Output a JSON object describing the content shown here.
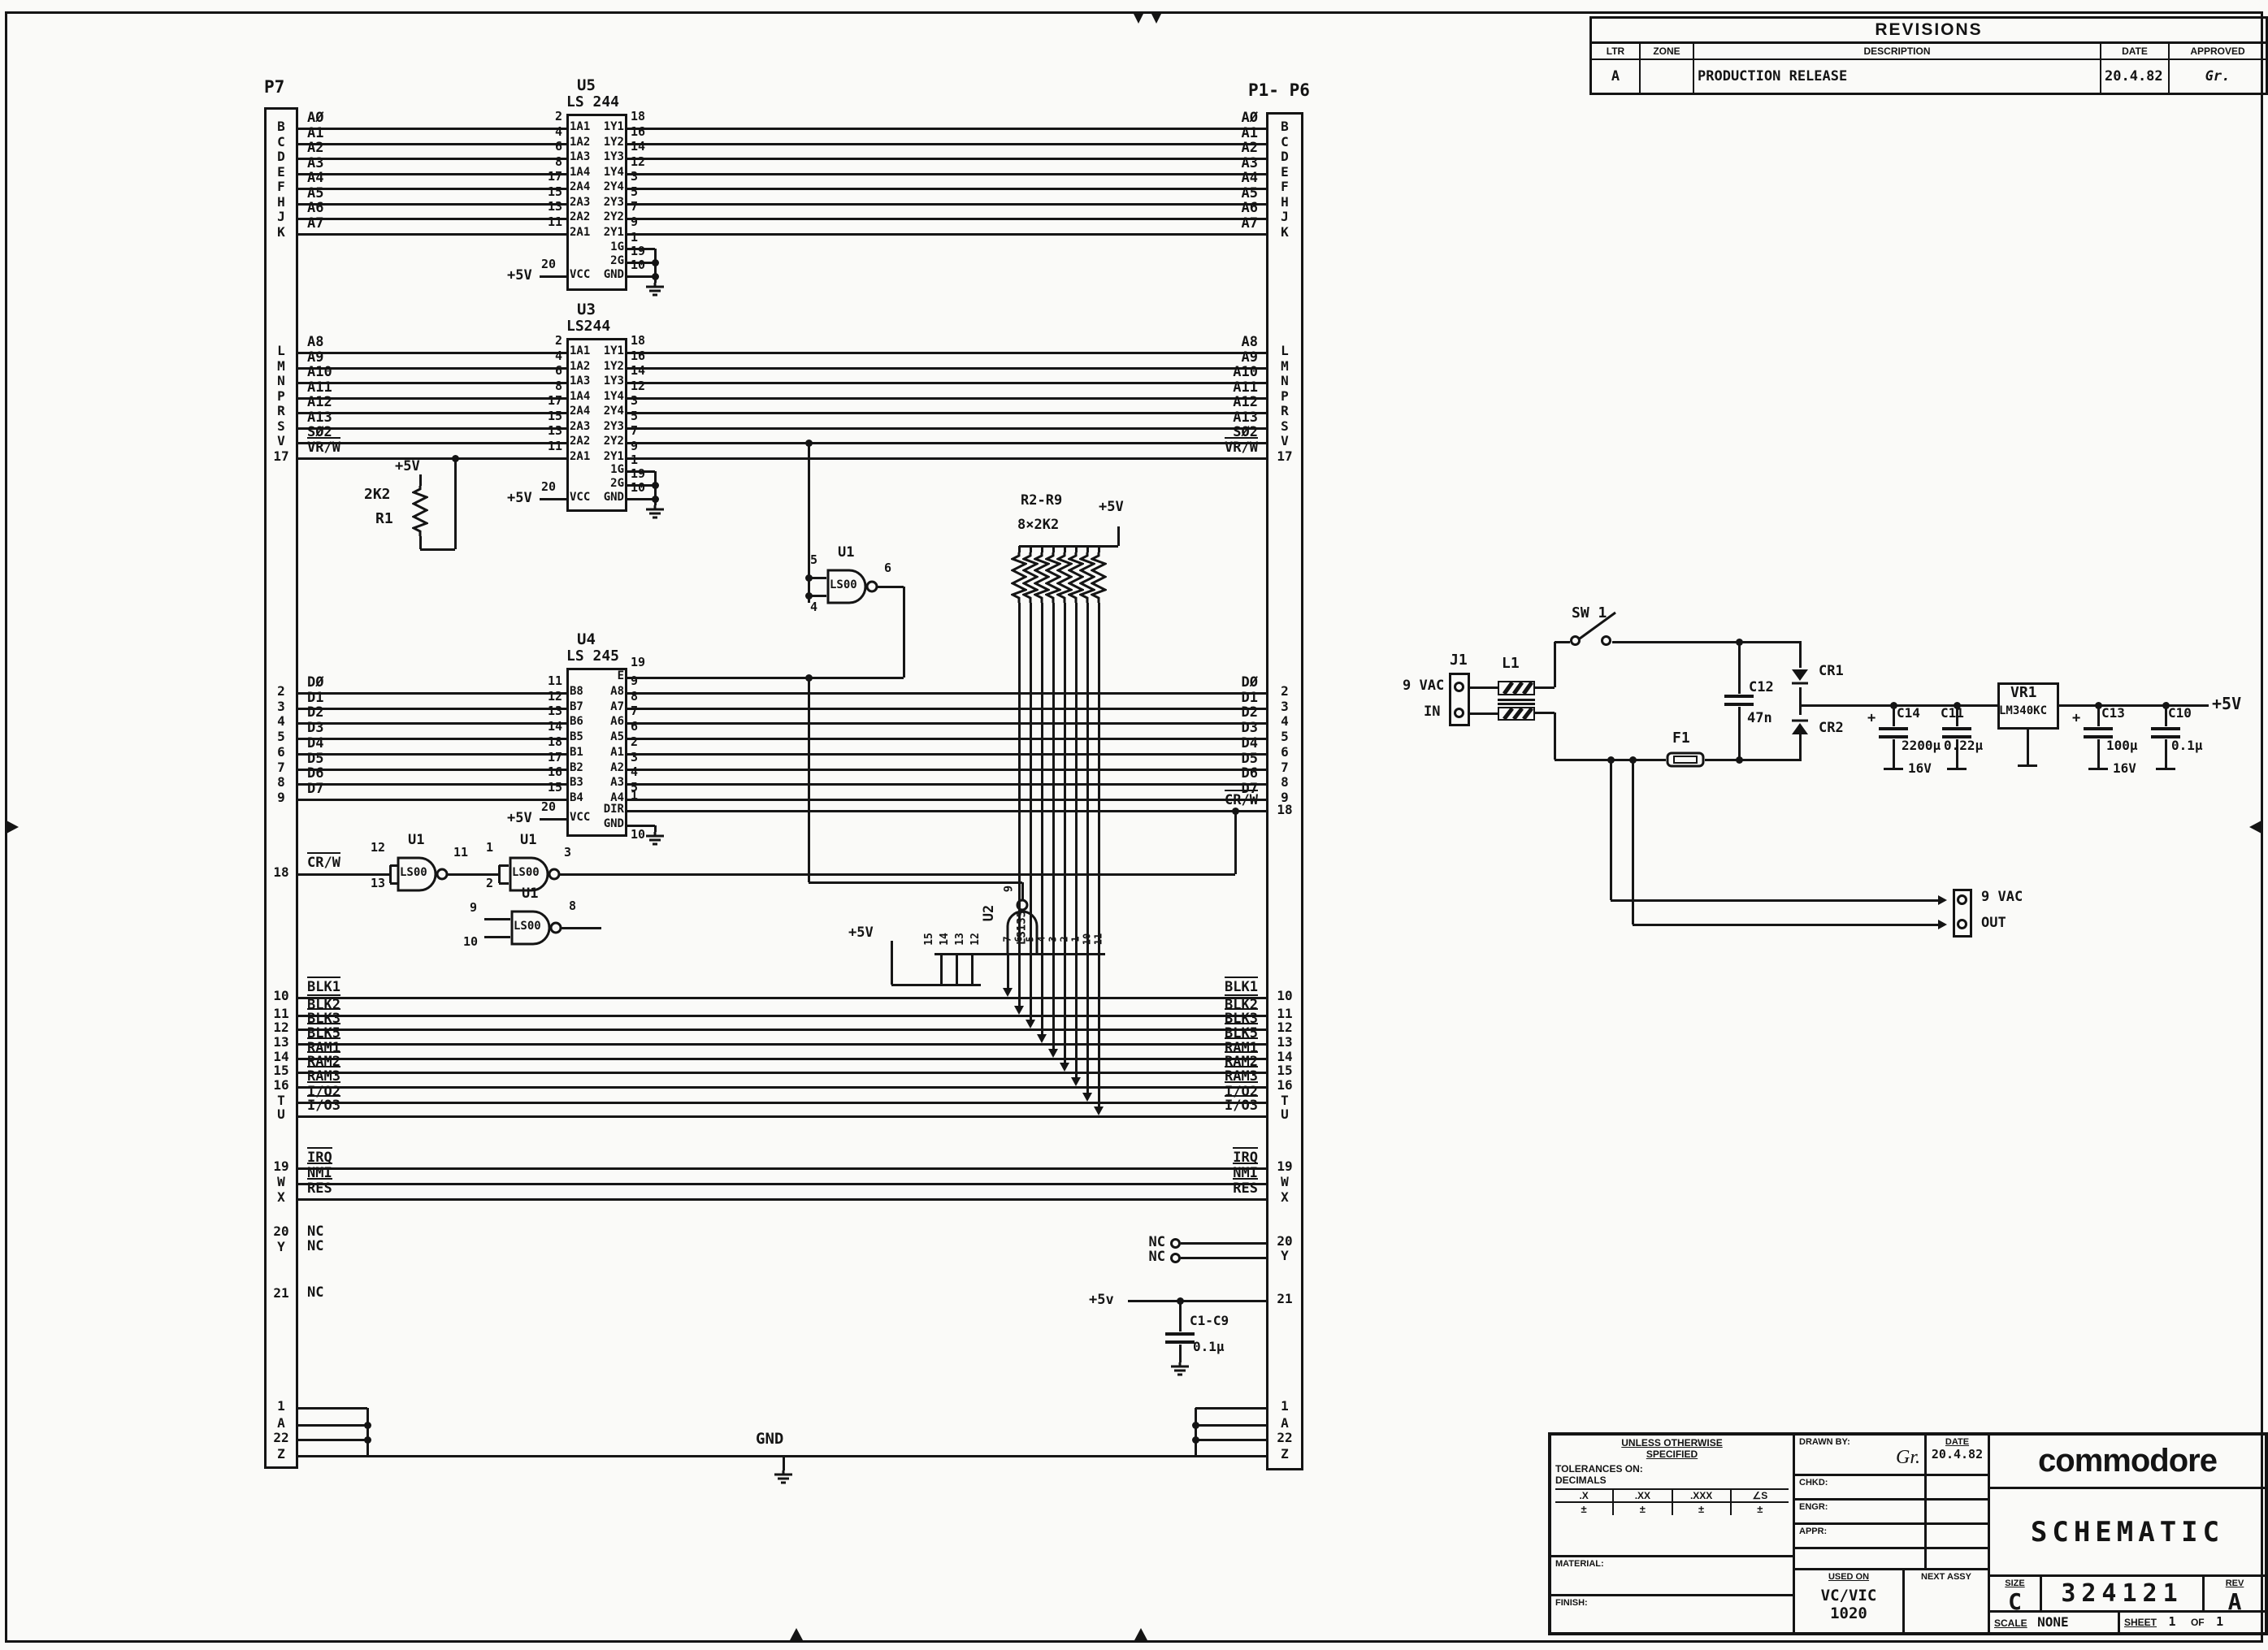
{
  "revisions": {
    "title": "REVISIONS",
    "col_ltr": "LTR",
    "col_zone": "ZONE",
    "col_desc": "DESCRIPTION",
    "col_date": "DATE",
    "col_appr": "APPROVED",
    "row_ltr": "A",
    "row_zone": "",
    "row_desc": "PRODUCTION RELEASE",
    "row_date": "20.4.82",
    "row_appr": "Gr."
  },
  "title_block": {
    "spec_note_1": "UNLESS OTHERWISE",
    "spec_note_2": "SPECIFIED",
    "tolerances": "TOLERANCES ON:",
    "decimals": "DECIMALS",
    "tol_x": ".X",
    "tol_xx": ".XX",
    "tol_xxx": ".XXX",
    "tol_ang": "∠S",
    "pm": "±",
    "material": "MATERIAL:",
    "finish": "FINISH:",
    "drawn_by": "DRAWN BY:",
    "drawn_sig": "Gr.",
    "date_label": "DATE",
    "date": "20.4.82",
    "chkd": "CHKD:",
    "engr": "ENGR:",
    "appr": "APPR:",
    "used_on": "USED ON",
    "used_on_value_1": "VC/VIC",
    "used_on_value_2": "1020",
    "next_assy": "NEXT ASSY",
    "brand": "commodore",
    "title": "SCHEMATIC",
    "size_label": "SIZE",
    "size": "C",
    "number": "324121",
    "rev_label": "REV",
    "rev": "A",
    "scale_label": "SCALE",
    "scale": "NONE",
    "sheet_label": "SHEET",
    "sheet_no": "1",
    "of_label": "OF",
    "of_no": "1"
  },
  "schematic": {
    "connector_left": "P7",
    "connector_right": "P1- P6",
    "plus5v": "+5V",
    "plus5v_low": "+5v",
    "gnd": "GND",
    "nc": "NC",
    "u5": {
      "ref": "U5",
      "part": "LS 244",
      "rows": [
        {
          "signal": "AØ",
          "conn": "B",
          "pin_in": "2",
          "label_in": "1A1",
          "label_out": "1Y1",
          "pin_out": "18"
        },
        {
          "signal": "A1",
          "conn": "C",
          "pin_in": "4",
          "label_in": "1A2",
          "label_out": "1Y2",
          "pin_out": "16"
        },
        {
          "signal": "A2",
          "conn": "D",
          "pin_in": "6",
          "label_in": "1A3",
          "label_out": "1Y3",
          "pin_out": "14"
        },
        {
          "signal": "A3",
          "conn": "E",
          "pin_in": "8",
          "label_in": "1A4",
          "label_out": "1Y4",
          "pin_out": "12"
        },
        {
          "signal": "A4",
          "conn": "F",
          "pin_in": "17",
          "label_in": "2A4",
          "label_out": "2Y4",
          "pin_out": "3"
        },
        {
          "signal": "A5",
          "conn": "H",
          "pin_in": "15",
          "label_in": "2A3",
          "label_out": "2Y3",
          "pin_out": "5"
        },
        {
          "signal": "A6",
          "conn": "J",
          "pin_in": "13",
          "label_in": "2A2",
          "label_out": "2Y2",
          "pin_out": "7"
        },
        {
          "signal": "A7",
          "conn": "K",
          "pin_in": "11",
          "label_in": "2A1",
          "label_out": "2Y1",
          "pin_out": "9"
        }
      ],
      "enables": [
        {
          "label": "1G",
          "pin": "1"
        },
        {
          "label": "2G",
          "pin": "19"
        }
      ],
      "gnd": {
        "label": "GND",
        "pin": "10"
      },
      "vcc": {
        "label": "VCC",
        "pin": "20"
      }
    },
    "u3": {
      "ref": "U3",
      "part": "LS244",
      "rows": [
        {
          "signal": "A8",
          "conn": "L",
          "pin_in": "2",
          "label_in": "1A1",
          "label_out": "1Y1",
          "pin_out": "18"
        },
        {
          "signal": "A9",
          "conn": "M",
          "pin_in": "4",
          "label_in": "1A2",
          "label_out": "1Y2",
          "pin_out": "16"
        },
        {
          "signal": "A10",
          "conn": "N",
          "pin_in": "6",
          "label_in": "1A3",
          "label_out": "1Y3",
          "pin_out": "14"
        },
        {
          "signal": "A11",
          "conn": "P",
          "pin_in": "8",
          "label_in": "1A4",
          "label_out": "1Y4",
          "pin_out": "12"
        },
        {
          "signal": "A12",
          "conn": "R",
          "pin_in": "17",
          "label_in": "2A4",
          "label_out": "2Y4",
          "pin_out": "3"
        },
        {
          "signal": "A13",
          "conn": "S",
          "pin_in": "15",
          "label_in": "2A3",
          "label_out": "2Y3",
          "pin_out": "5"
        },
        {
          "signal": "SØ2",
          "conn": "V",
          "pin_in": "13",
          "label_in": "2A2",
          "label_out": "2Y2",
          "pin_out": "7"
        },
        {
          "signal": "VR/W",
          "ov": true,
          "conn": "17",
          "pin_in": "11",
          "label_in": "2A1",
          "label_out": "2Y1",
          "pin_out": "9"
        }
      ],
      "enables": [
        {
          "label": "1G",
          "pin": "1"
        },
        {
          "label": "2G",
          "pin": "19"
        }
      ],
      "gnd": {
        "label": "GND",
        "pin": "10"
      },
      "vcc": {
        "label": "VCC",
        "pin": "20"
      }
    },
    "u4": {
      "ref": "U4",
      "part": "LS 245",
      "enable": {
        "label": "E",
        "pin": "19"
      },
      "rows": [
        {
          "signal": "DØ",
          "conn": "2",
          "pin_in": "11",
          "label_in": "B8",
          "label_out": "A8",
          "pin_out": "9"
        },
        {
          "signal": "D1",
          "conn": "3",
          "pin_in": "12",
          "label_in": "B7",
          "label_out": "A7",
          "pin_out": "8"
        },
        {
          "signal": "D2",
          "conn": "4",
          "pin_in": "13",
          "label_in": "B6",
          "label_out": "A6",
          "pin_out": "7"
        },
        {
          "signal": "D3",
          "conn": "5",
          "pin_in": "14",
          "label_in": "B5",
          "label_out": "A5",
          "pin_out": "6"
        },
        {
          "signal": "D4",
          "conn": "6",
          "pin_in": "18",
          "label_in": "B1",
          "label_out": "A1",
          "pin_out": "2"
        },
        {
          "signal": "D5",
          "conn": "7",
          "pin_in": "17",
          "label_in": "B2",
          "label_out": "A2",
          "pin_out": "3"
        },
        {
          "signal": "D6",
          "conn": "8",
          "pin_in": "16",
          "label_in": "B3",
          "label_out": "A3",
          "pin_out": "4"
        },
        {
          "signal": "D7",
          "conn": "9",
          "pin_in": "15",
          "label_in": "B4",
          "label_out": "A4",
          "pin_out": "5"
        }
      ],
      "dir": {
        "label": "DIR",
        "pin": "1"
      },
      "gnd": {
        "label": "GND",
        "pin": "10"
      },
      "vcc": {
        "label": "VCC",
        "pin": "20"
      }
    },
    "crw": {
      "signal": "CR/W",
      "ov": true,
      "conn": "18"
    },
    "gates": [
      {
        "ref": "U1",
        "part": "LS00",
        "in": [
          "12",
          "13"
        ],
        "out": "11"
      },
      {
        "ref": "U1",
        "part": "LS00",
        "in": [
          "1",
          "2"
        ],
        "out": "3"
      },
      {
        "ref": "U1",
        "part": "LS00",
        "in": [
          "9",
          "10"
        ],
        "out": "8"
      },
      {
        "ref": "U1",
        "part": "LS00",
        "in": [
          "5",
          "4"
        ],
        "out": "6"
      }
    ],
    "u2": {
      "ref": "U2",
      "part": "LS133",
      "out_pin": "9",
      "tied_pins": [
        "15",
        "14",
        "13",
        "12"
      ],
      "input_pins": [
        "7",
        "6",
        "5",
        "4",
        "3",
        "2",
        "1",
        "10",
        "11"
      ]
    },
    "r1": {
      "ref": "R1",
      "value": "2K2"
    },
    "rnet": {
      "ref": "R2-R9",
      "value": "8×2K2"
    },
    "select_lines": [
      {
        "signal": "BLK1",
        "ov": true,
        "conn": "10"
      },
      {
        "signal": "BLK2",
        "ov": true,
        "conn": "11"
      },
      {
        "signal": "BLK3",
        "ov": true,
        "conn": "12"
      },
      {
        "signal": "BLK5",
        "ov": true,
        "conn": "13"
      },
      {
        "signal": "RAM1",
        "ov": true,
        "conn": "14"
      },
      {
        "signal": "RAM2",
        "ov": true,
        "conn": "15"
      },
      {
        "signal": "RAM3",
        "ov": true,
        "conn": "16"
      },
      {
        "signal": "I/O2",
        "ov": true,
        "conn": "T"
      },
      {
        "signal": "I/O3",
        "ov": true,
        "conn": "U"
      }
    ],
    "interrupt_lines": [
      {
        "signal": "IRQ",
        "ov": true,
        "conn": "19"
      },
      {
        "signal": "NMI",
        "ov": true,
        "conn": "W"
      },
      {
        "signal": "RES",
        "ov": true,
        "conn": "X"
      }
    ],
    "nc_pins_left": [
      "20",
      "Y",
      "21"
    ],
    "nc_pins_right": [
      {
        "conn": "20"
      },
      {
        "conn": "Y"
      }
    ],
    "bypass": {
      "conn": "21",
      "ref": "C1-C9",
      "value": "0.1µ"
    },
    "gnd_pins": [
      "1",
      "A",
      "22",
      "Z"
    ]
  },
  "power": {
    "j1": {
      "ref": "J1",
      "line1": "9 VAC",
      "line2": "IN"
    },
    "l1": {
      "ref": "L1"
    },
    "sw1": {
      "ref": "SW 1"
    },
    "f1": {
      "ref": "F1"
    },
    "c12": {
      "ref": "C12",
      "value": "47n"
    },
    "cr1": {
      "ref": "CR1"
    },
    "cr2": {
      "ref": "CR2"
    },
    "c14": {
      "ref": "C14",
      "plus": "+",
      "value": "2200µ",
      "voltage": "16V"
    },
    "c11": {
      "ref": "C11",
      "value": "0.22µ"
    },
    "vr1": {
      "ref": "VR1",
      "part": "LM340KC"
    },
    "c13": {
      "ref": "C13",
      "plus": "+",
      "value": "100µ",
      "voltage": "16V"
    },
    "c10": {
      "ref": "C10",
      "value": "0.1µ"
    },
    "out": {
      "line1": "9 VAC",
      "line2": "OUT"
    },
    "rail": "+5V"
  }
}
